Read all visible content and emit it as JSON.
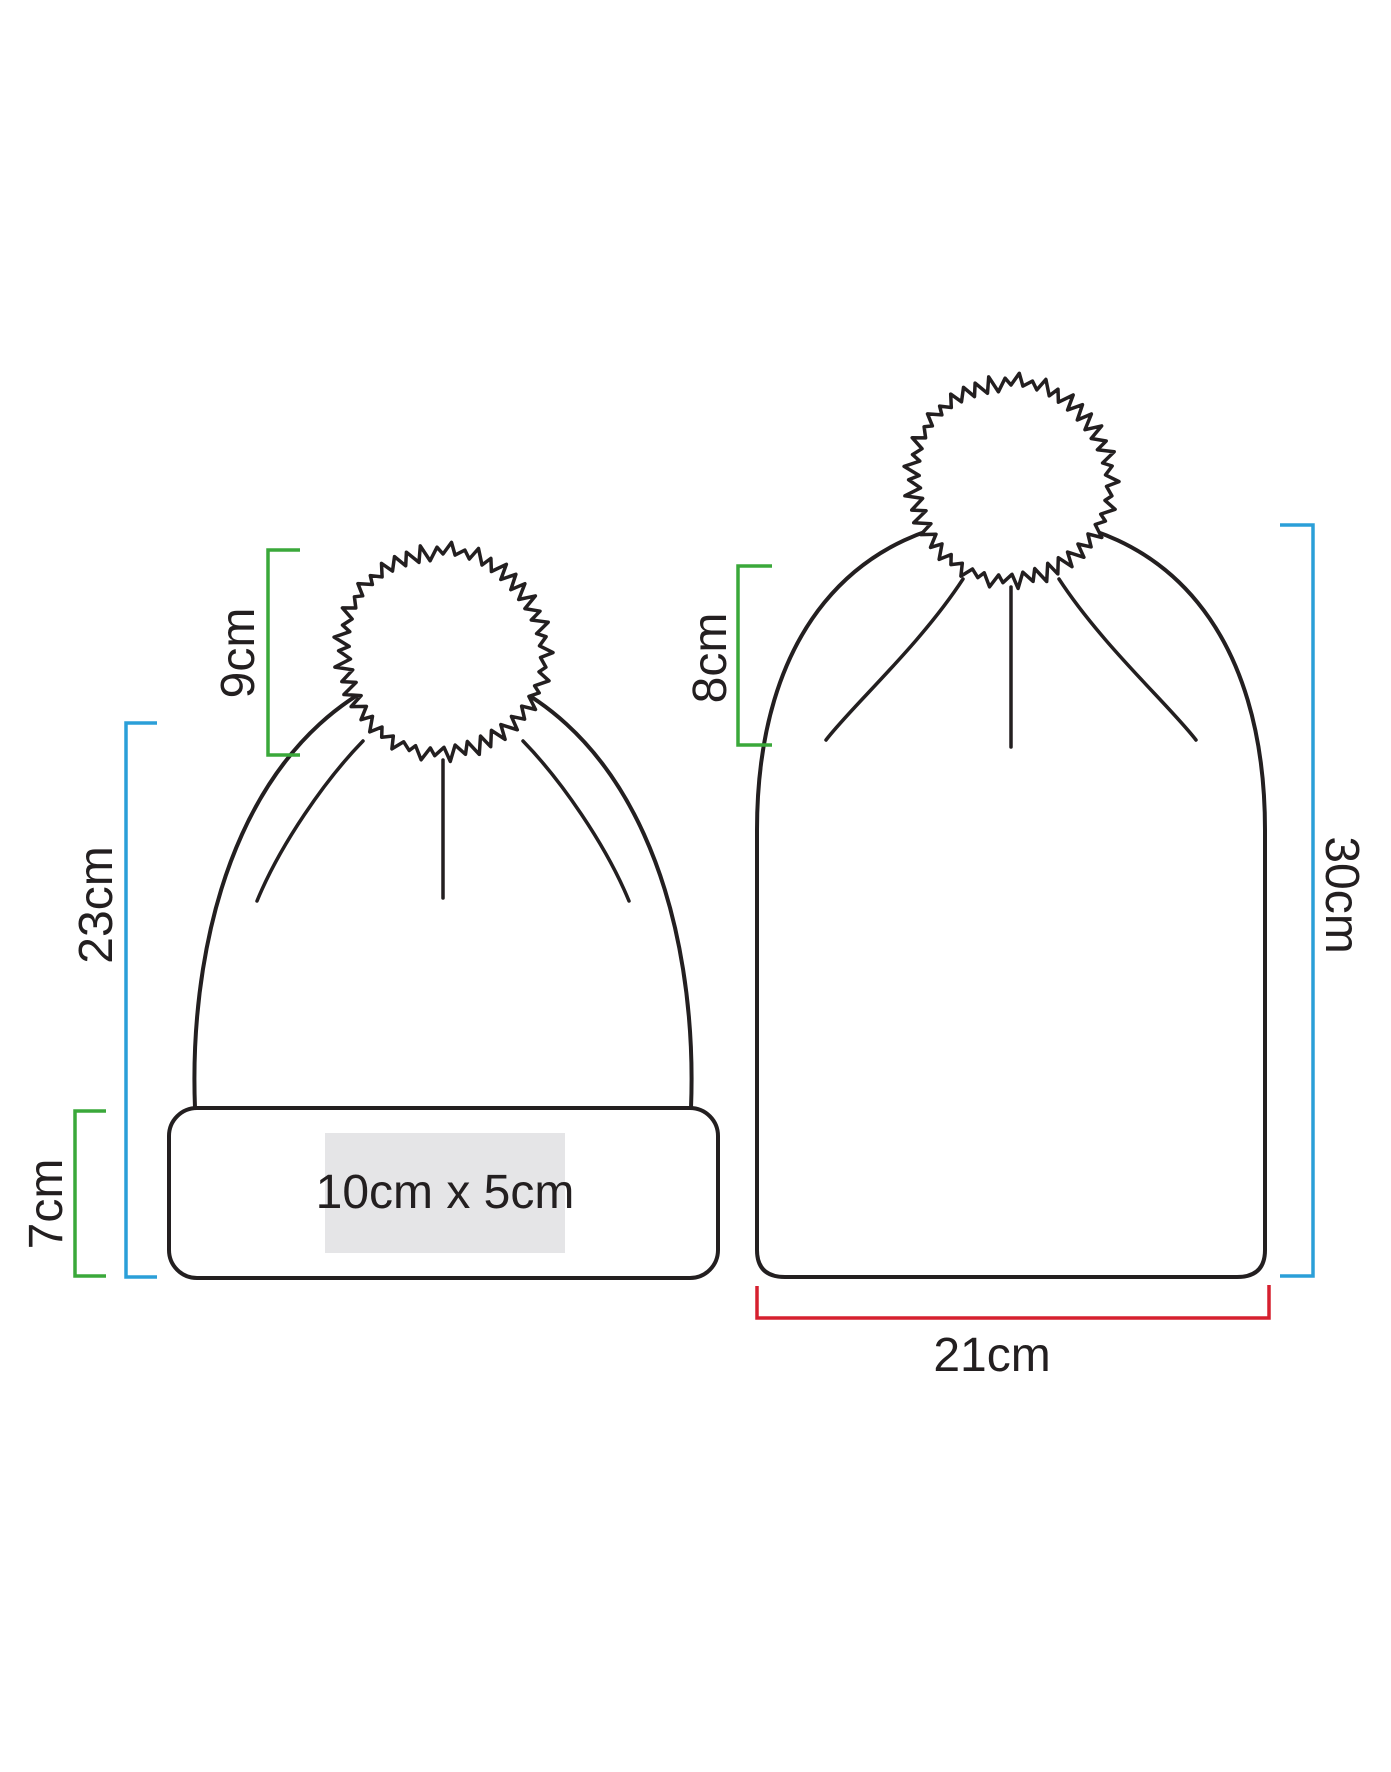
{
  "figure": {
    "background": "#ffffff",
    "outline_color": "#231f20",
    "annotation_colors": {
      "green": "#3aa83a",
      "blue": "#2b9fd8",
      "red": "#d6202f"
    },
    "left_beanie": {
      "pom_height": "9cm",
      "body_height": "23cm",
      "cuff_height": "7cm",
      "print_area_size": "10cm x 5cm",
      "print_area_fill": "#e5e5e7"
    },
    "right_beanie": {
      "pom_height": "8cm",
      "body_height": "30cm",
      "width": "21cm"
    }
  }
}
